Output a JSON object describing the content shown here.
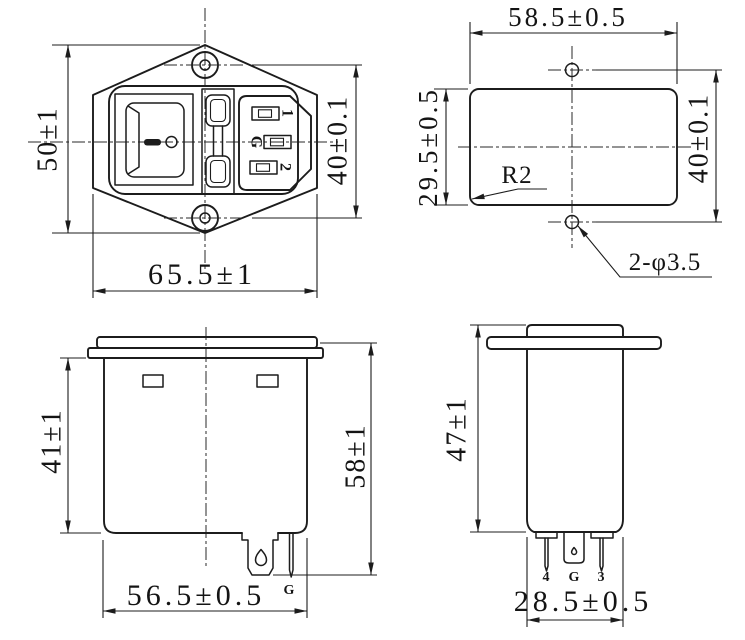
{
  "doc": {
    "background": "#ffffff",
    "line_color": "#1c1c1c",
    "text_color": "#141414"
  },
  "front_view": {
    "dim_height": "50±1",
    "dim_hole_spacing": "40±0.1",
    "dim_width": "65.5±1",
    "pin_top_label": "1",
    "pin_earth_label": "G",
    "pin_bottom_label": "2"
  },
  "cutout_view": {
    "dim_width": "58.5±0.5",
    "dim_height": "29.5±0.5",
    "dim_hole_spacing": "40±0.1",
    "corner_radius_callout": "R2",
    "hole_callout": "2-φ3.5"
  },
  "side_view": {
    "dim_body_height": "41±1",
    "dim_total_height": "58±1",
    "dim_width": "56.5±0.5",
    "earth_terminal_label": "G"
  },
  "end_view": {
    "dim_height": "47±1",
    "dim_width": "28.5±0.5",
    "pin_left_label": "4",
    "pin_middle_label": "G",
    "pin_right_label": "3"
  }
}
